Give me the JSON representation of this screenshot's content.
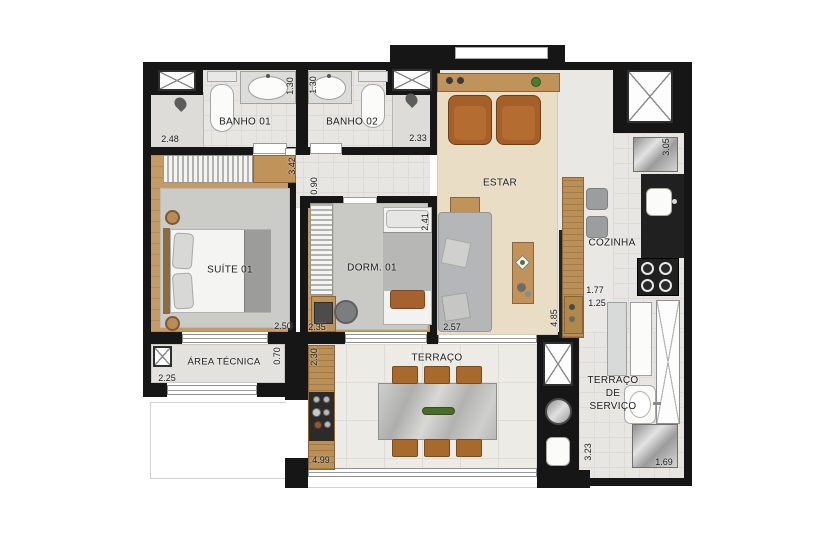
{
  "plan": {
    "type": "apartment-floor-plan",
    "language": "pt-BR"
  },
  "rooms": {
    "banho01": "BANHO 01",
    "banho02": "BANHO 02",
    "suite": "SUÍTE 01",
    "dorm": "DORM. 01",
    "estar": "ESTAR",
    "cozinha": "COZINHA",
    "area_tecnica": "ÁREA TÉCNICA",
    "terraco": "TERRAÇO",
    "terraco_servico_l1": "TERRAÇO",
    "terraco_servico_l2": "DE",
    "terraco_servico_l3": "SERVIÇO"
  },
  "dimensions": {
    "d248": "2.48",
    "d130a": "1.30",
    "d130b": "1.30",
    "d233": "2.33",
    "d342": "3.42",
    "d090": "0.90",
    "d250": "2.50",
    "d235": "2.35",
    "d241": "2.41",
    "d257": "2.57",
    "d485": "4.85",
    "d305": "3.05",
    "d177": "1.77",
    "d125": "1.25",
    "d070": "0.70",
    "d225": "2.25",
    "d230": "2.30",
    "d499": "4.99",
    "d323": "3.23",
    "d169": "1.69"
  },
  "colors": {
    "wall": "#161616",
    "wood": "#c49b67",
    "tile": "#e8e7e3",
    "rug_beige": "#e9ddc5",
    "rug_gray": "#cbcbc8",
    "leather": "#a55f28",
    "marble": "#bdbdbb",
    "counter_black": "#202020",
    "steel": "#c0c0c0",
    "plant": "#4e7c2f"
  }
}
